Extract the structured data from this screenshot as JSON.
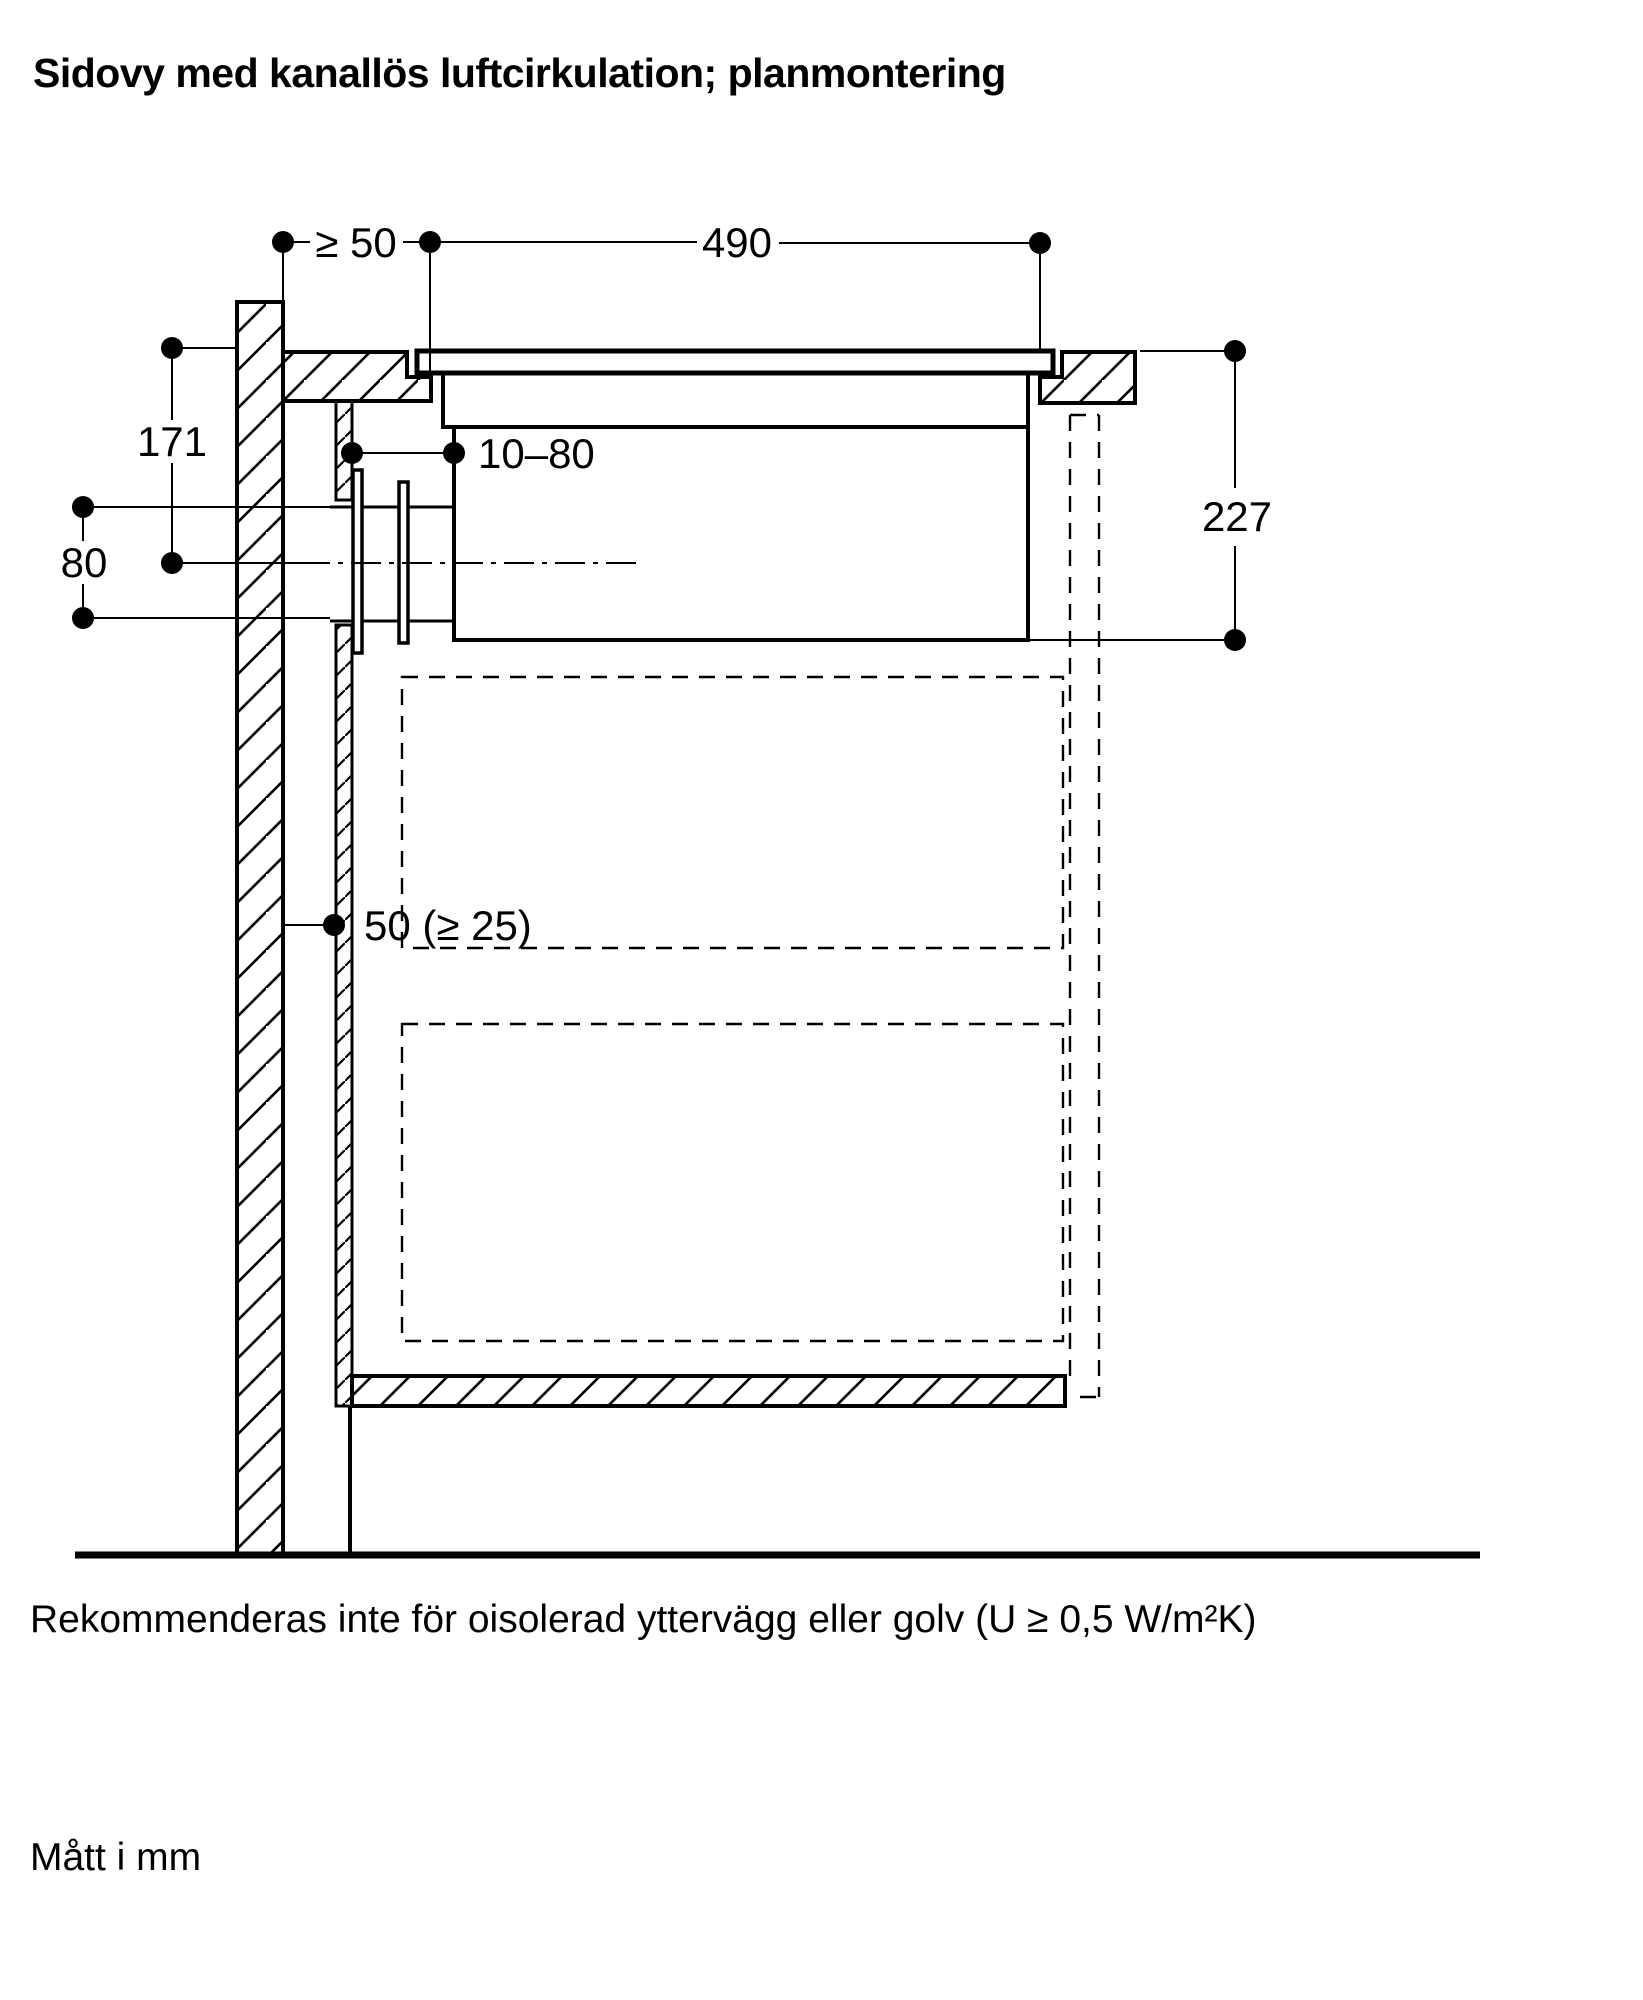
{
  "title": "Sidovy med kanallös luftcirkulation; planmontering",
  "footnote": "Rekommenderas inte för oisolerad yttervägg eller golv (U ≥ 0,5 W/m²K)",
  "units_note": "Mått i mm",
  "dimensions": {
    "wall_to_cutout": "≥ 50",
    "cutout_width": "490",
    "top_to_duct_center": "171",
    "duct_height": "80",
    "panel_to_appliance": "10–80",
    "appliance_height": "227",
    "wall_to_panel": "50 (≥ 25)"
  },
  "colors": {
    "line": "#000000",
    "background": "#ffffff"
  }
}
